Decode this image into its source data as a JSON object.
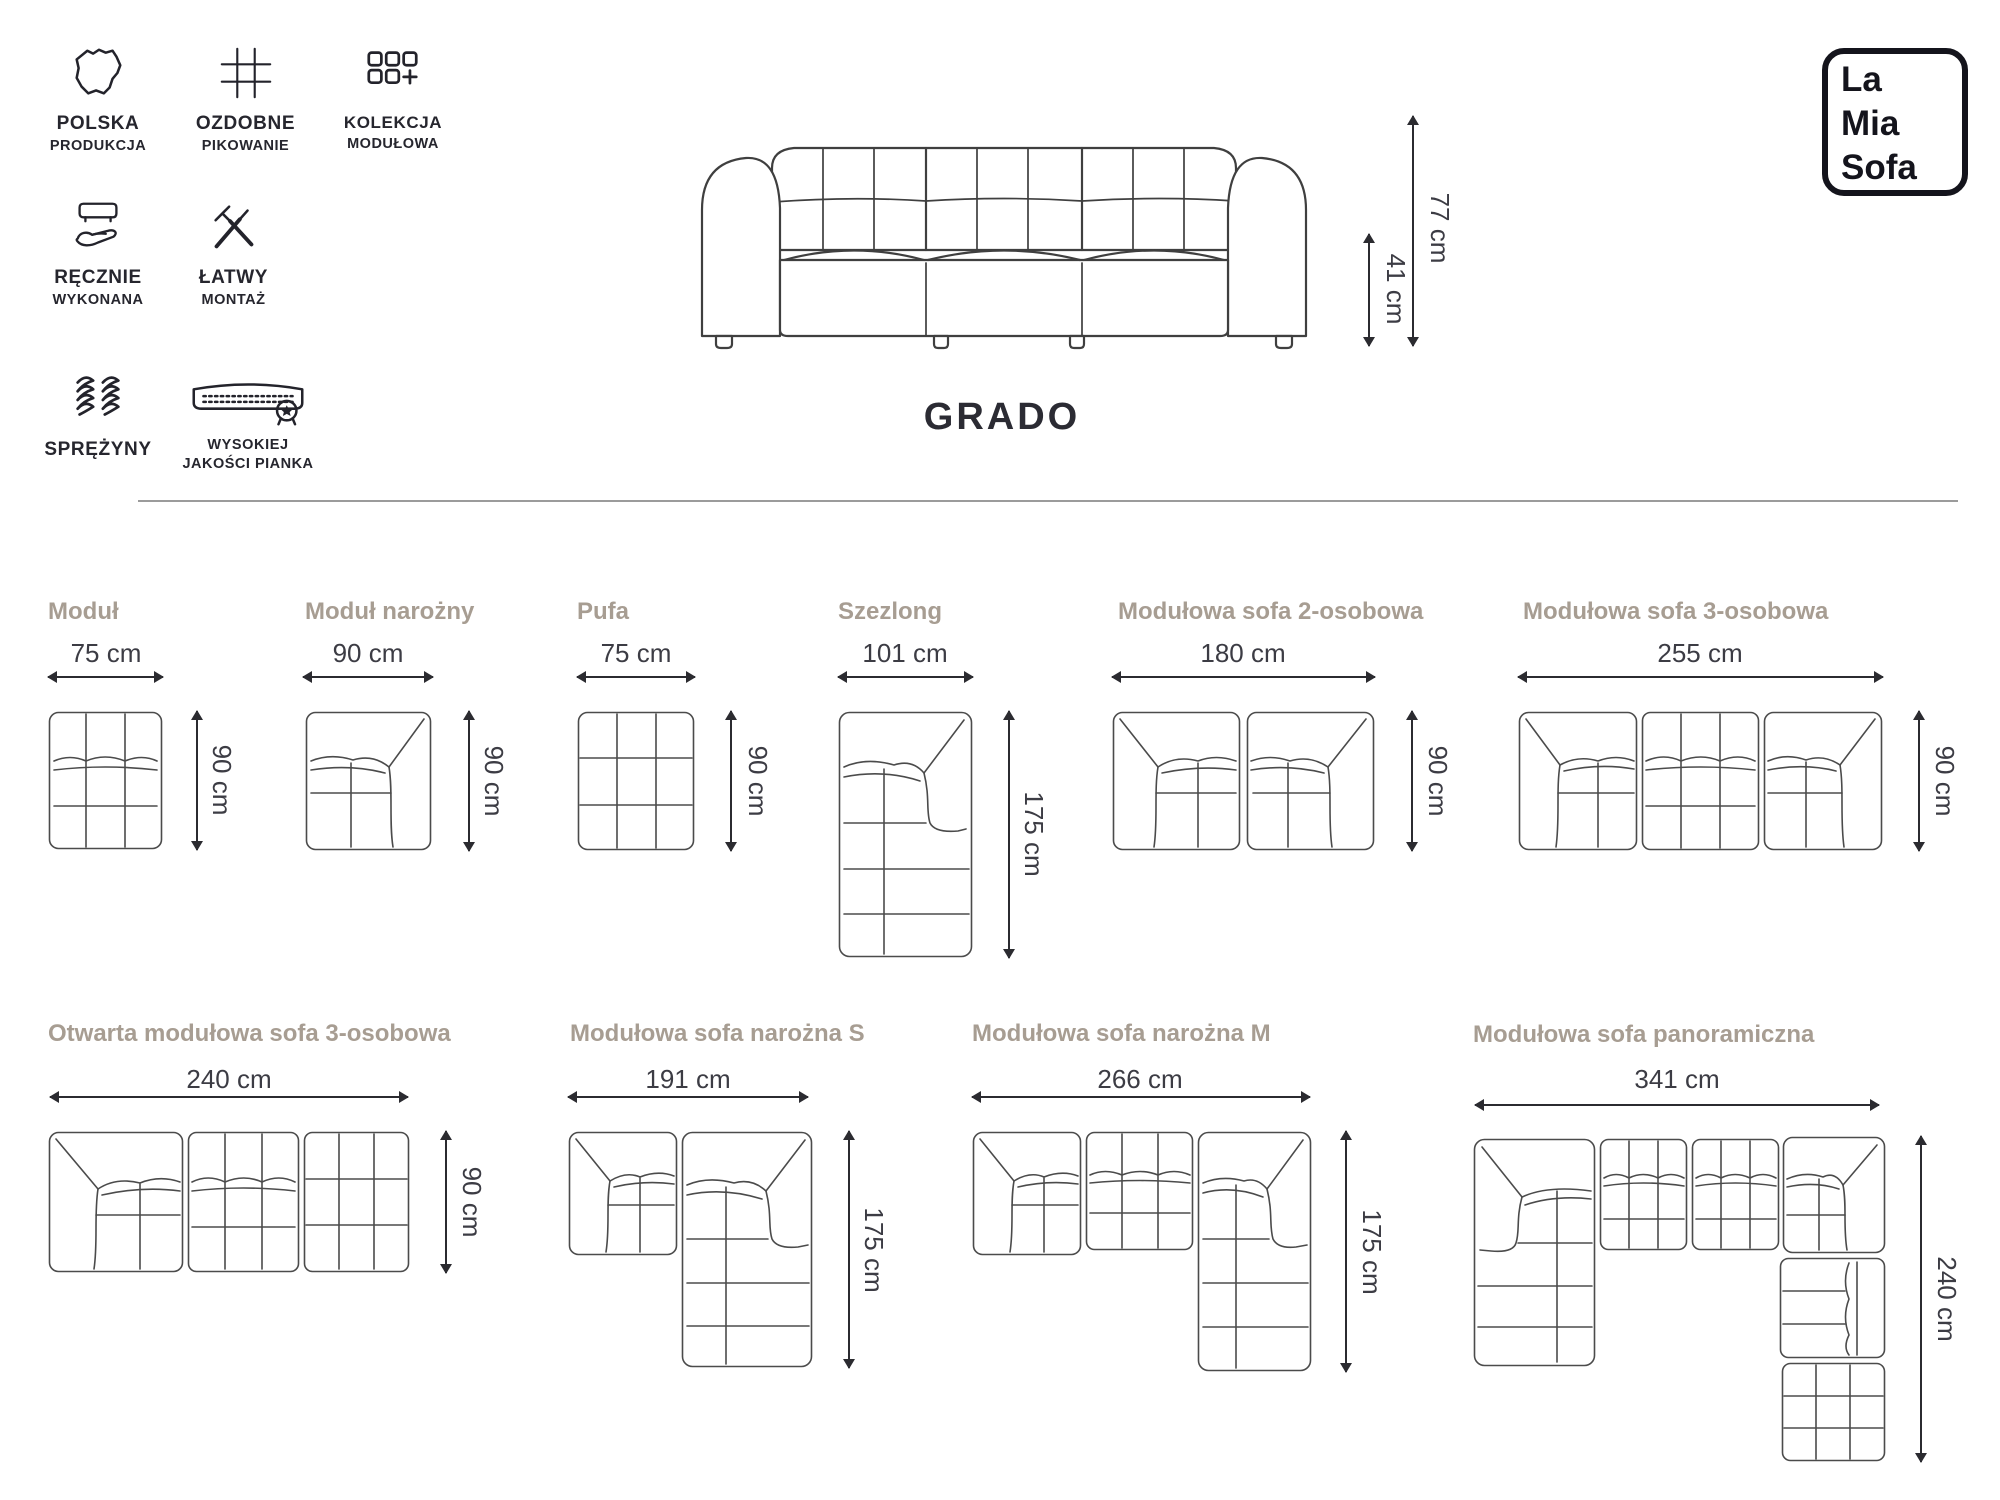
{
  "header": {
    "features": [
      {
        "icon": "poland-map-icon",
        "line1": "POLSKA",
        "line2": "PRODUKCJA"
      },
      {
        "icon": "quilting-grid-icon",
        "line1": "OZDOBNE",
        "line2": "PIKOWANIE"
      },
      {
        "icon": "modular-collection-icon",
        "line1": "KOLEKCJA",
        "line2": "MODUŁOWA"
      },
      {
        "icon": "handmade-icon",
        "line1": "RĘCZNIE",
        "line2": "WYKONANA"
      },
      {
        "icon": "easy-assembly-icon",
        "line1": "ŁATWY",
        "line2": "MONTAŻ"
      },
      {
        "icon": "springs-icon",
        "line1": "SPRĘŻYNY"
      },
      {
        "icon": "foam-quality-icon",
        "line1": "WYSOKIEJ",
        "line2": "JAKOŚCI PIANKA"
      }
    ],
    "product_name": "GRADO",
    "hero_dims": {
      "height": "77 cm",
      "seat_height": "41 cm"
    },
    "logo": {
      "line1": "La",
      "line2": "Mia",
      "line3": "Sofa"
    }
  },
  "colors": {
    "accent_heading": "#a79d92",
    "text_dark": "#2b2b33",
    "line_art": "#4b4b4b"
  },
  "modules": [
    {
      "name": "Moduł",
      "width": "75 cm",
      "depth": "90 cm"
    },
    {
      "name": "Moduł narożny",
      "width": "90 cm",
      "depth": "90 cm"
    },
    {
      "name": "Pufa",
      "width": "75 cm",
      "depth": "90 cm"
    },
    {
      "name": "Szezlong",
      "width": "101 cm",
      "depth": "175 cm"
    },
    {
      "name": "Modułowa sofa 2-osobowa",
      "width": "180 cm",
      "depth": "90 cm"
    },
    {
      "name": "Modułowa sofa 3-osobowa",
      "width": "255 cm",
      "depth": "90 cm"
    },
    {
      "name": "Otwarta modułowa sofa 3-osobowa",
      "width": "240 cm",
      "depth": "90 cm"
    },
    {
      "name": "Modułowa sofa narożna S",
      "width": "191 cm",
      "depth": "175 cm"
    },
    {
      "name": "Modułowa sofa narożna M",
      "width": "266 cm",
      "depth": "175 cm"
    },
    {
      "name": "Modułowa sofa panoramiczna",
      "width": "341 cm",
      "depth": "240 cm"
    }
  ]
}
